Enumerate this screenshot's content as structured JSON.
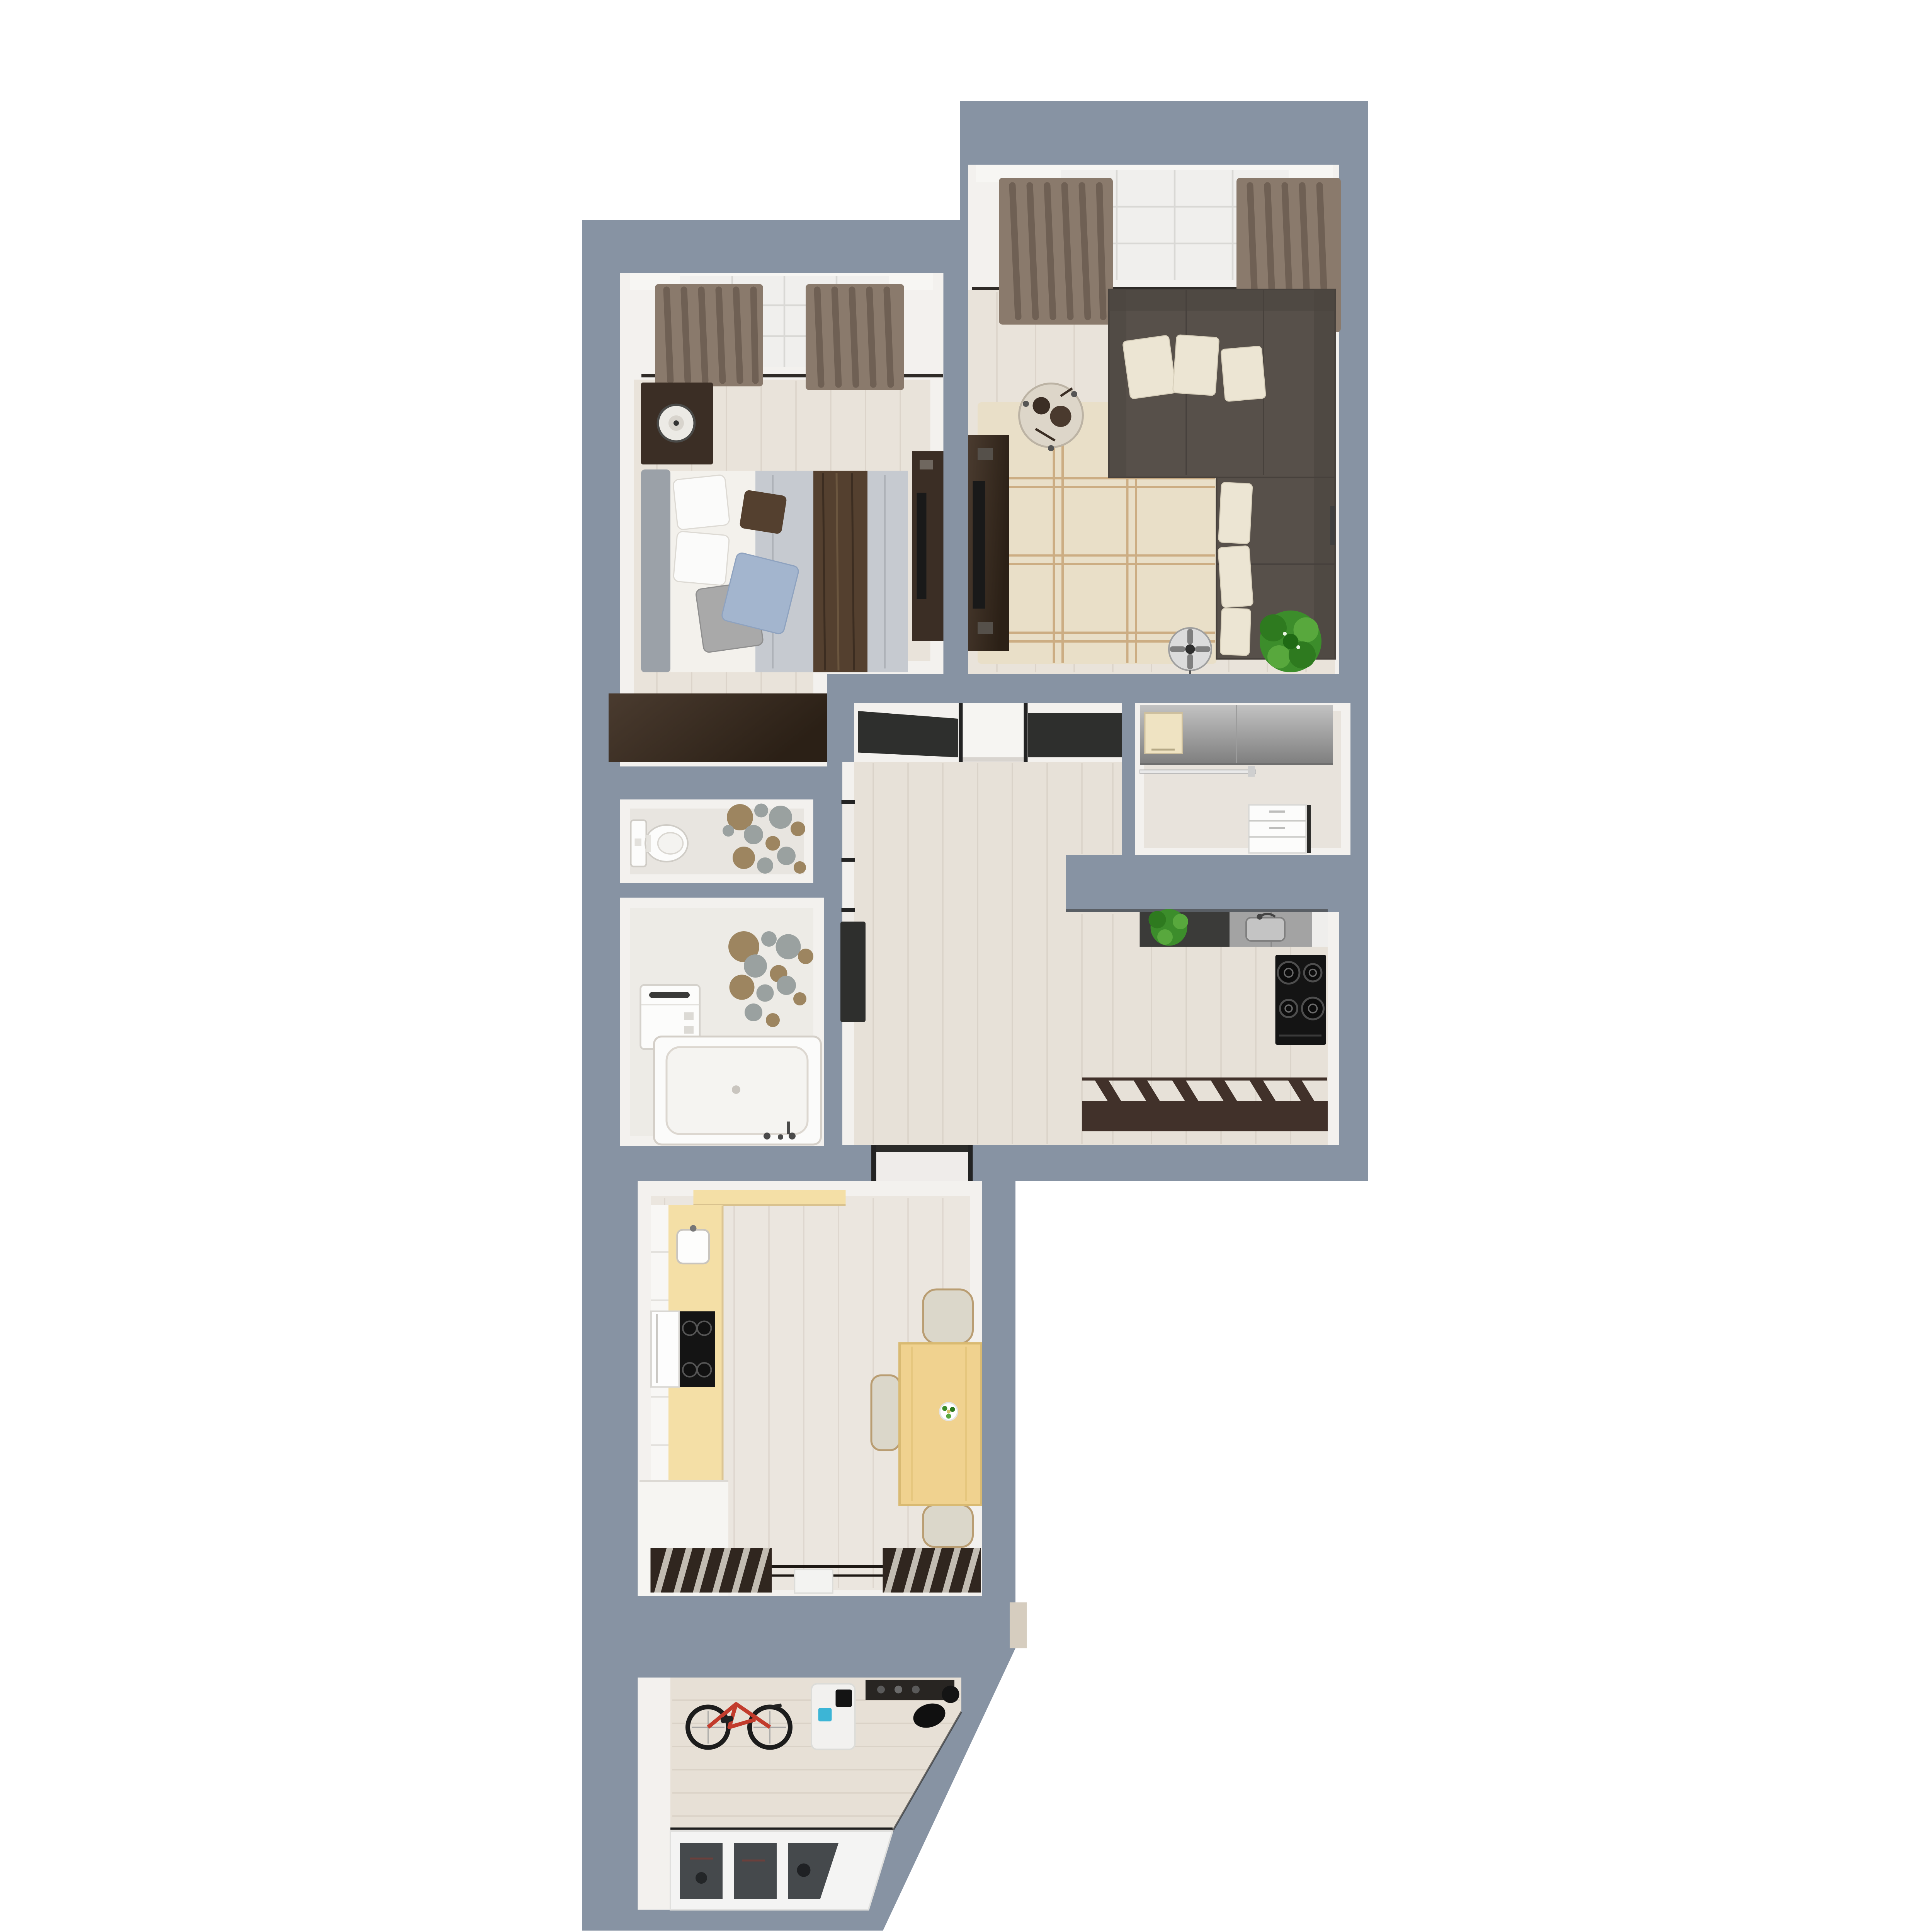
{
  "title": "apartment-3d-floor-plan",
  "colors": {
    "bg": "#ffffff",
    "wall": "#8793a3",
    "wallFace": "#f3f1ee",
    "sillWhite": "#f7f6f3",
    "floorMain": "#e9e3da",
    "floorCool": "#e7e1d8",
    "trimDark": "#2e2a26",
    "rug": "#e9dfc8",
    "rugLine": "#c9a87c",
    "sofa": "#57504a",
    "sofaDark": "#47413c",
    "cushion": "#ece5d3",
    "curtain": "#8a7a6c",
    "curtainDark": "#66584c",
    "shade": "#f0efed",
    "shadeLine": "#d9d8d5",
    "woodDark": "#3b2e25",
    "tvBlack": "#191919",
    "headboard": "#9ba1a8",
    "blanket": "#c6cad0",
    "runner": "#54402f",
    "pillowBlue": "#a3b5ce",
    "pillowGray": "#a9a9a9",
    "porcelain": "#fcfcfb",
    "circleTan": "#9d8560",
    "circleGray": "#9aa1a0",
    "counterYellow": "#f4dfa6",
    "tableWood": "#f0d28f",
    "chairBeige": "#dbd7ca",
    "chairTrim": "#b99d72",
    "rackDark": "#30261f",
    "slatLight": "#cac4bb",
    "stoveBlack": "#141414",
    "counterDark": "#3b3b39",
    "counterGray": "#a3a3a3",
    "sinkLight": "#c4c4c4",
    "benchBrown": "#41312a",
    "plantGreen": "#3c8d2b",
    "plantDark": "#2e7a1f",
    "plantLight": "#58a83d",
    "bikeRed": "#c23b2c",
    "tireDark": "#1f1f1f",
    "glassDark": "#45494c",
    "accentBlue": "#3cb5d6",
    "microBeige": "#efe3c2",
    "pantryCounterTop": "#bcbcbc",
    "pantryCounterBottom": "#7f7f7f",
    "doorDark": "#2e2f2d",
    "jamb": "#232323",
    "matWhite": "#f3f3f1",
    "notchBeige": "#d6cdbf",
    "ovenWhite": "#fdfdfd",
    "tubRim": "#fbfbfa",
    "tubInner": "#f5f4f1"
  },
  "rooms": [
    {
      "id": "bedroom",
      "furniture": [
        "window-shade",
        "curtains",
        "nightstand",
        "lamp",
        "double-bed",
        "pillows",
        "bed-runner",
        "wardrobe-dresser",
        "tv-dresser"
      ]
    },
    {
      "id": "living-room",
      "furniture": [
        "window-shade",
        "curtains",
        "corner-sofa",
        "sofa-cushions",
        "plaid-rug",
        "tv-cabinet",
        "side-table",
        "floor-fan",
        "potted-plant"
      ]
    },
    {
      "id": "wc",
      "furniture": [
        "toilet",
        "wall-circles-decor"
      ]
    },
    {
      "id": "bathroom",
      "furniture": [
        "washing-machine",
        "bathtub",
        "wall-circles-decor"
      ]
    },
    {
      "id": "hallway",
      "furniture": [
        "open-door-bedroom",
        "doorway-living",
        "open-door-bathroom",
        "doorway-dining"
      ]
    },
    {
      "id": "pantry",
      "furniture": [
        "sliding-wardrobe",
        "microwave",
        "hanging-rail",
        "white-drawers"
      ]
    },
    {
      "id": "kitchen",
      "furniture": [
        "dark-counter",
        "potted-plant",
        "sink-counter",
        "gas-stove",
        "slatted-bench"
      ]
    },
    {
      "id": "dining-room",
      "furniture": [
        "yellow-counter",
        "kitchen-sink",
        "cooktop",
        "oven",
        "dining-table",
        "chairs",
        "flower-vase",
        "drying-racks",
        "floor-mat"
      ]
    },
    {
      "id": "balcony",
      "furniture": [
        "bicycle",
        "wall-shelf",
        "white-stand",
        "window-glazing"
      ]
    }
  ]
}
